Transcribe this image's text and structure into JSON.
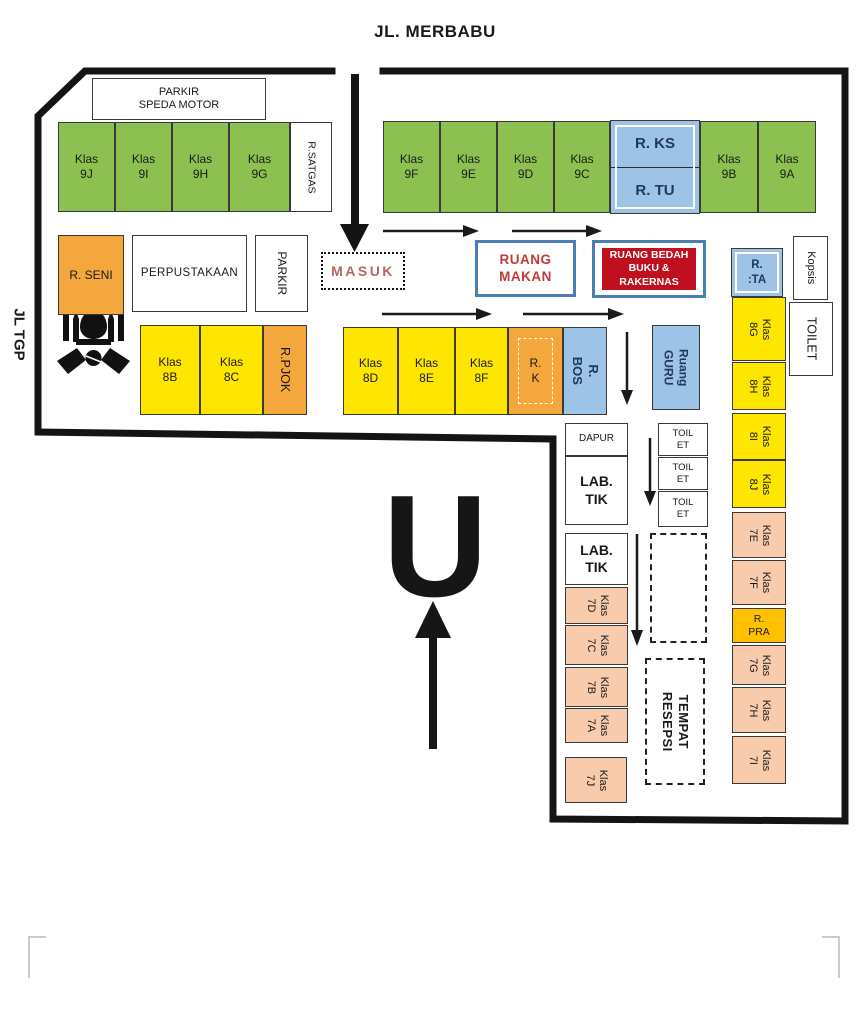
{
  "title": "JL. MERBABU",
  "street_left": "JL TGP",
  "compass_letter": "U",
  "icons": {
    "mosque": "mosque-handshake-icon",
    "north": "north-up-arrow",
    "entrance": "entrance-down-arrow",
    "flow_arrows": "direction-arrows"
  },
  "colors": {
    "classroom_9": "#8CC152",
    "classroom_8": "#FFE600",
    "classroom_7": "#F8CBAD",
    "office_orange": "#F3A73C",
    "pra_gold": "#FFC000",
    "admin_blue": "#9DC3E6",
    "frame_blue": "#4a7fb5",
    "event_red": "#C01020",
    "makan_text_red": "#C23B3B",
    "masuk_text": "#B06A63"
  },
  "rooms": {
    "parkir_speda": "PARKIR\nSPEDA MOTOR",
    "klas_9j": "Klas\n9J",
    "klas_9i": "Klas\n9I",
    "klas_9h": "Klas\n9H",
    "klas_9g": "Klas\n9G",
    "r_satgas": "R.SATGAS",
    "klas_9f": "Klas\n9F",
    "klas_9e": "Klas\n9E",
    "klas_9d": "Klas\n9D",
    "klas_9c": "Klas\n9C",
    "r_ks": "R. KS",
    "r_tu": "R. TU",
    "klas_9b": "Klas\n9B",
    "klas_9a": "Klas\n9A",
    "r_seni": "R. SENI",
    "perpustakaan": "PERPUSTAKAAN",
    "parkir": "PARKIR",
    "masuk": "MASUK",
    "ruang_makan": "RUANG\nMAKAN",
    "bedah_buku": "RUANG\nBEDAH BUKU\n& RAKERNAS",
    "r_ta": "R.\n:TA",
    "kopsis": "Kopsis",
    "toilet": "TOILET",
    "klas_8b": "Klas\n8B",
    "klas_8c": "Klas\n8C",
    "r_pjok": "R.PJOK",
    "klas_8d": "Klas\n8D",
    "klas_8e": "Klas\n8E",
    "klas_8f": "Klas\n8F",
    "r_k": "R.\nK",
    "r_bos": "R. BOS",
    "ruang_guru": "Ruang\nGURU",
    "klas_8g": "Klas\n8G",
    "klas_8h": "Klas\n8H",
    "klas_8i": "Klas\n8I",
    "klas_8j": "Klas\n8J",
    "klas_7e": "Klas\n7E",
    "klas_7f": "Klas\n7F",
    "r_pra": "R.\nPRA",
    "klas_7g": "Klas\n7G",
    "klas_7h": "Klas\n7H",
    "klas_7i": "Klas\n7I",
    "dapur": "DAPUR",
    "lab_tik_1": "LAB.\nTIK",
    "lab_tik_2": "LAB.\nTIK",
    "klas_7d": "Klas\n7D",
    "klas_7c": "Klas\n7C",
    "klas_7b": "Klas\n7B",
    "klas_7a": "Klas\n7A",
    "klas_7j": "Klas\n7J",
    "toilet_small_1": "TOIL\nET",
    "toilet_small_2": "TOIL\nET",
    "toilet_small_3": "TOIL\nET",
    "tempat_resepsi": "TEMPAT\nRESEPSI"
  }
}
